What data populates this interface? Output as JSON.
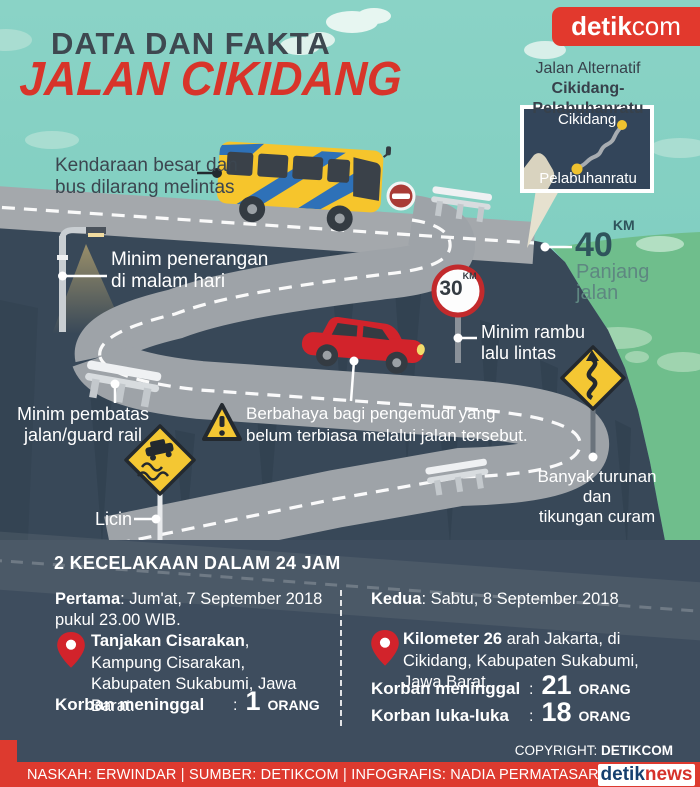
{
  "header": {
    "kicker": "DATA DAN FAKTA",
    "title": "JALAN CIKIDANG",
    "logo_bold": "detik",
    "logo_light": "com"
  },
  "map_inset": {
    "title_line1": "Jalan Alternatif",
    "title_line2": "Cikidang-Pelabuhanratu",
    "city_top": "Cikidang",
    "city_bottom": "Pelabuhanratu"
  },
  "stats": {
    "distance_value": "40",
    "distance_unit": "KM",
    "distance_label_line1": "Panjang",
    "distance_label_line2": "jalan",
    "speed_sign_value": "30",
    "speed_sign_unit": "KM"
  },
  "callouts": {
    "bus": [
      "Kendaraan besar dan",
      "bus dilarang melintas"
    ],
    "lighting": [
      "Minim penerangan",
      "di malam hari"
    ],
    "signs": [
      "Minim rambu",
      "lalu lintas"
    ],
    "guardrail": [
      "Minim pembatas",
      "jalan/guard rail"
    ],
    "danger": [
      "Berbahaya bagi pengemudi yang",
      "belum terbiasa melalui jalan tersebut."
    ],
    "slippery": "Licin",
    "curves": [
      "Banyak turunan dan",
      "tikungan curam"
    ]
  },
  "accidents": {
    "heading": "2 KECELAKAAN DALAM 24 JAM",
    "first": {
      "label": "Pertama",
      "datetime_rest": ": Jum'at, 7 September 2018",
      "datetime_line2": "pukul 23.00 WIB.",
      "location_bold": "Tanjakan Cisarakan",
      "location_rest": ", Kampung Cisarakan, Kabupaten Sukabumi, Jawa Barat.",
      "casualties": [
        {
          "label": "Korban meninggal",
          "colon": ":",
          "value": "1",
          "unit": "ORANG"
        }
      ]
    },
    "second": {
      "label": "Kedua",
      "datetime_rest": ": Sabtu, 8 September 2018",
      "location_bold": "Kilometer 26",
      "location_rest": " arah Jakarta, di Cikidang, Kabupaten Sukabumi, Jawa Barat.",
      "casualties": [
        {
          "label": "Korban meninggal",
          "colon": ":",
          "value": "21",
          "unit": "ORANG"
        },
        {
          "label": "Korban luka-luka",
          "colon": ":",
          "value": "18",
          "unit": "ORANG"
        }
      ]
    }
  },
  "footer": {
    "copyright_label": "COPYRIGHT: ",
    "copyright_value": "DETIKCOM",
    "credits": "NASKAH: ERWINDAR | SUMBER: DETIKCOM | INFOGRAFIS: NADIA PERMATASARI W",
    "brand_bold": "detik",
    "brand_light": "news"
  },
  "colors": {
    "sky": "#7ECDBF",
    "cliff": "#384858",
    "panel": "#3E4D5E",
    "road": "#9EA3A8",
    "accent_red": "#DD3A2F",
    "sign_yellow": "#F4C733",
    "hill_green": "#6FBE8C"
  }
}
